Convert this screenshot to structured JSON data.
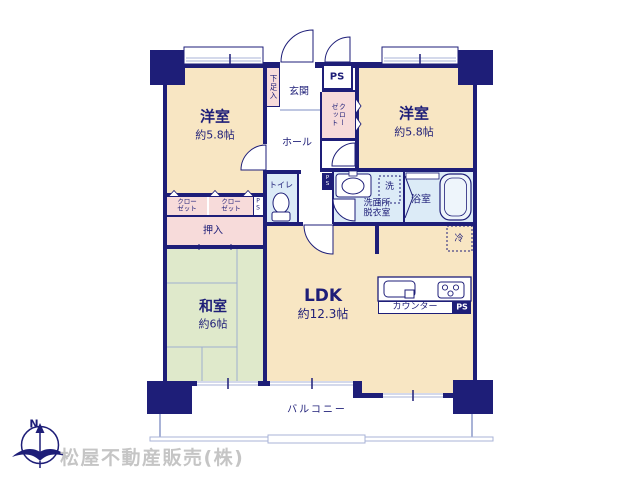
{
  "branding": {
    "company": "松屋不動産販売(株)",
    "compass_north": "N"
  },
  "rooms": {
    "bedroom_left": {
      "name": "洋室",
      "size": "約5.8帖"
    },
    "bedroom_right": {
      "name": "洋室",
      "size": "約5.8帖"
    },
    "japanese_room": {
      "name": "和室",
      "size": "約6帖"
    },
    "ldk": {
      "name": "LDK",
      "size": "約12.3帖"
    },
    "hall": {
      "name": "ホール"
    },
    "entrance": {
      "name": "玄関"
    },
    "shoe_cabinet": {
      "name": "下足入"
    },
    "toilet": {
      "name": "トイレ"
    },
    "washroom": {
      "name": "洗面所\n脱衣室"
    },
    "bathroom": {
      "name": "浴室"
    },
    "balcony": {
      "name": "バルコニー"
    }
  },
  "storage": {
    "closet_left_1": "クロー\nゼット",
    "closet_left_2": "クロー\nゼット",
    "closet_right": "クローゼット",
    "oshiire": "押入"
  },
  "fixtures": {
    "washer": "洗",
    "refrigerator": "冷",
    "counter": "カウンター"
  },
  "shafts": {
    "ps_entrance": "PS",
    "ps_closet": "P\nS",
    "ps_washroom": "P\nS",
    "ps_kitchen": "PS"
  },
  "colors": {
    "wall_navy": "#1e1e78",
    "room_cream": "#f8e6c3",
    "tatami_green": "#dfe9cb",
    "closet_pink": "#f7dbda",
    "wet_blue": "#dcebf7",
    "railing_blue": "#a9b3d7",
    "company_gray": "#c5c5c5"
  }
}
